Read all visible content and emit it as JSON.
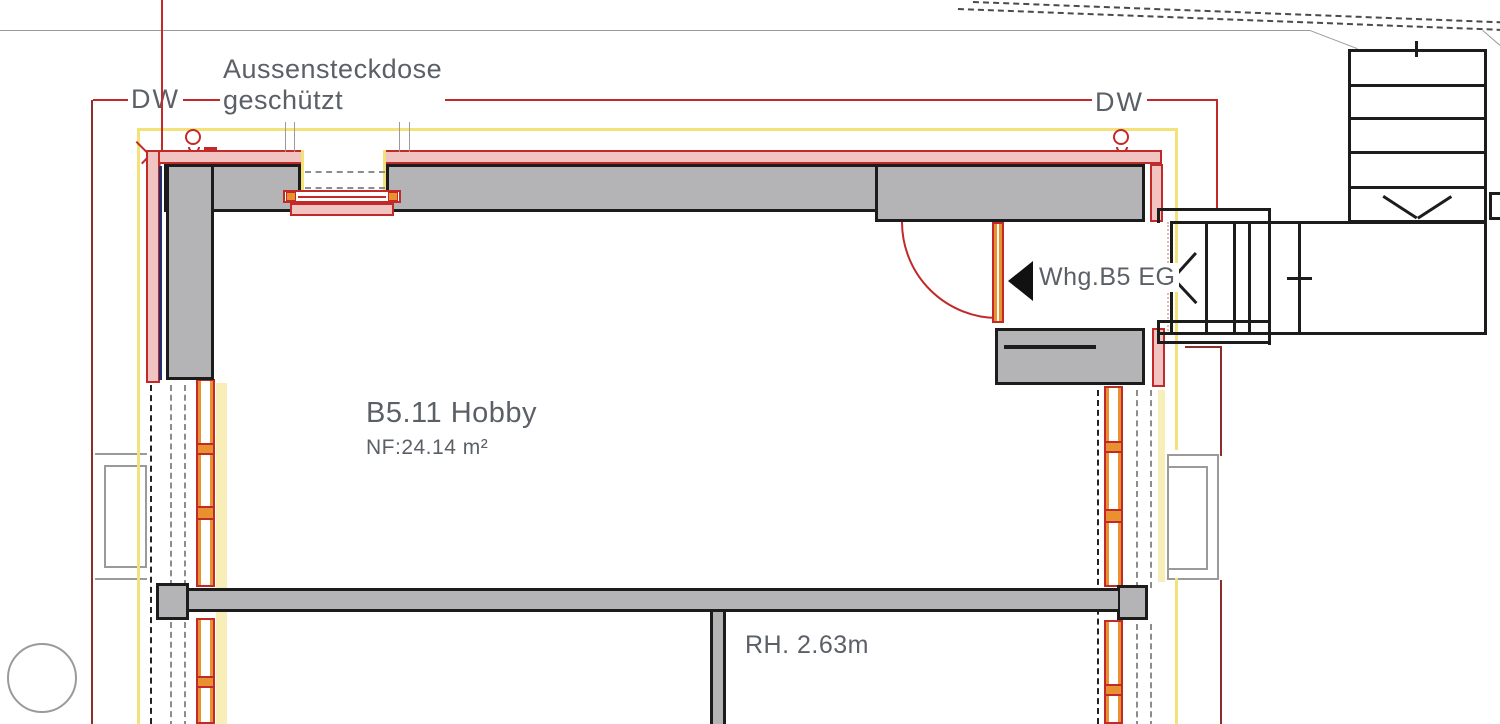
{
  "plan_title": "Floor plan B5 ground floor (detail)",
  "room": {
    "name": "B5.11 Hobby",
    "floor_area": "NF:24.14 m²",
    "clear_height": "RH. 2.63m"
  },
  "entry": {
    "label": "Whg.B5 EG"
  },
  "annotations": {
    "downpipe_left": {
      "label": "DW"
    },
    "downpipe_right": {
      "label": "DW"
    },
    "outdoor_socket": {
      "line1": "Aussensteckdose",
      "line2": "geschützt"
    }
  },
  "colors": {
    "red": "#c22a2a",
    "darkred": "#8a2f2a",
    "pink": "#f2c4c1",
    "yellow": "#f2e279",
    "paleyellow": "#f8efb8",
    "orange": "#e9912f",
    "wallgray": "#b4b4b6",
    "ink": "#1c1c1c",
    "sitegray": "#9a9a9a",
    "dashgray": "#8d8d8d",
    "textgray": "#5b6067",
    "navy": "#23306e",
    "boundary": "#4a4a4a"
  }
}
